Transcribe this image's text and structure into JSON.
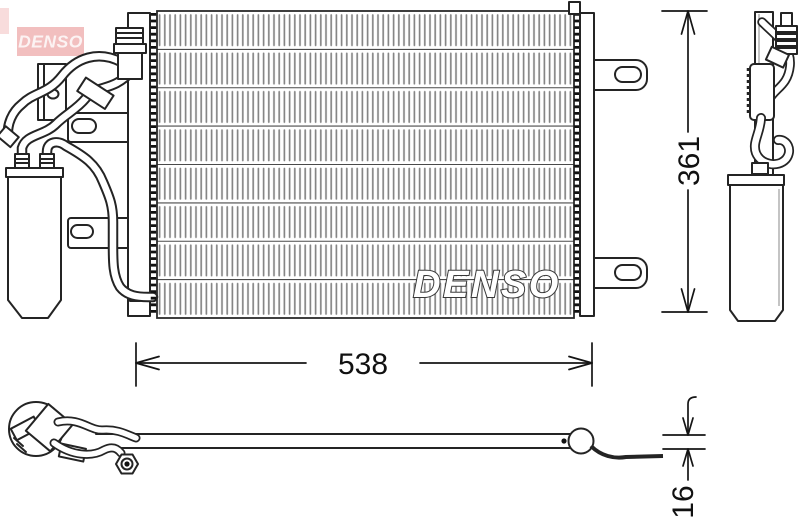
{
  "branding": {
    "logo_text": "DENSO",
    "watermark_text": "DENSO"
  },
  "dimensions": {
    "width_label": "538",
    "height_label": "361",
    "depth_label": "16"
  },
  "colors": {
    "logo_background": "#f2bfbf",
    "logo_text_color": "#fcf3f3",
    "line_color": "#242424",
    "fin_color": "#858585",
    "dimension_color": "#111111",
    "watermark_fill": "#ffffff",
    "background": "#ffffff"
  }
}
